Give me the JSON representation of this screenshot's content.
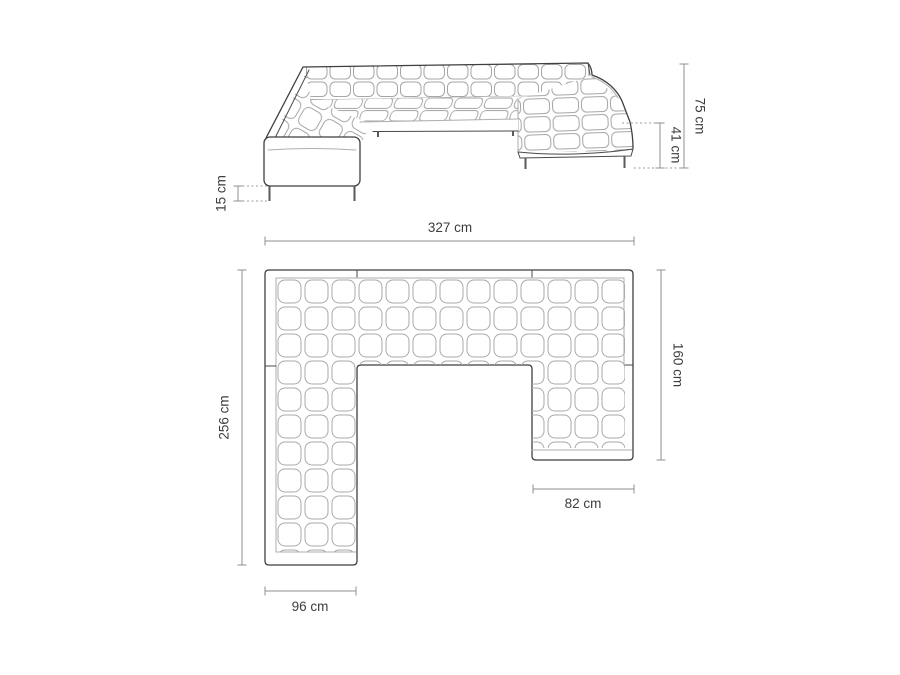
{
  "diagram": {
    "type": "furniture-dimension-drawing",
    "subject": "u-shaped-corner-sofa",
    "colors": {
      "background": "#ffffff",
      "outline": "#3f3f3f",
      "detail_lines": "#aeaeae",
      "dimension_lines": "#8f8f8f",
      "label_text": "#3d3d3d"
    },
    "elevation_view": {
      "dimensions": {
        "total_height": "75 cm",
        "seat_height": "41 cm",
        "leg_height": "15 cm"
      }
    },
    "plan_view": {
      "dimensions": {
        "total_width": "327 cm",
        "left_side_depth": "256 cm",
        "right_side_depth": "160 cm",
        "chaise_width": "82 cm",
        "left_wing_width": "96 cm"
      }
    }
  }
}
